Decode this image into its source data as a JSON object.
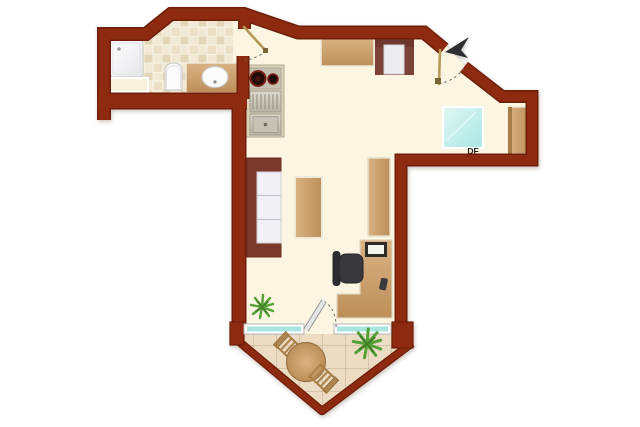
{
  "plan": {
    "skylight_label": "DF",
    "colors": {
      "wall": "#8e2a10",
      "wall-dark": "#6d1f0a",
      "floor": "#fbf5e2",
      "tile-a": "#f2e9d4",
      "tile-b": "#e3d5b8",
      "tile-c": "#ecdfc6",
      "balcony-tile": "#ebdcc3",
      "grout": "#c9b69b",
      "wood-light": "#d9b283",
      "wood-dark": "#bd8f58",
      "trim": "#efe9da",
      "sofa-frame": "#7a392a",
      "cushion": "#f1f0f4",
      "glass-a": "#dff8f6",
      "glass-b": "#a9e5e0",
      "steel-a": "#dedacd",
      "steel-b": "#b8b3a4",
      "chair-dark": "#38383d",
      "door-leaf": "#b49a55",
      "plant-a": "#55a035",
      "plant-b": "#3f7d26",
      "arrow": "#2e2e33",
      "fixture": "#fbfbfb"
    },
    "regions": [
      "bathroom",
      "hallway",
      "living-room",
      "balcony"
    ],
    "furniture": [
      "shower",
      "bath-cabinet",
      "toilet",
      "vanity-sink",
      "kitchenette",
      "sideboard",
      "armchair",
      "entrance-door",
      "north-arrow",
      "skylight",
      "wardrobe",
      "sofa",
      "coffee-table",
      "shelf",
      "desk",
      "monitor",
      "office-chair",
      "indoor-plant",
      "balcony-window-left",
      "balcony-window-right",
      "balcony-door",
      "balcony-table",
      "balcony-chair",
      "balcony-plant"
    ]
  }
}
